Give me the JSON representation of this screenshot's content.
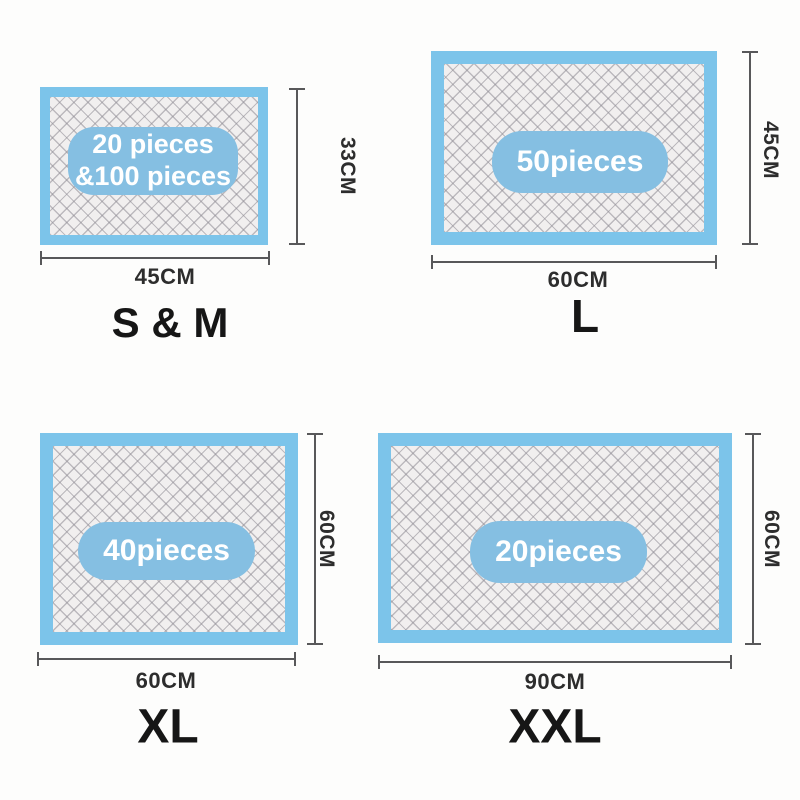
{
  "colors": {
    "background": "#fdfdfc",
    "pad_border_blue": "#7cc4ea",
    "pad_core_bg": "#f1efef",
    "pad_core_line": "#908d95",
    "badge_blue": "#85bfe2",
    "badge_text": "#ffffff",
    "dimension_line": "#58585a",
    "dimension_text": "#2d2d2d",
    "title_text": "#161616"
  },
  "panels": [
    {
      "id": "s-m",
      "title": "S & M",
      "badge_line1": "20 pieces",
      "badge_line2": "&100 pieces",
      "width_label": "45CM",
      "height_label": "33CM"
    },
    {
      "id": "l",
      "title": "L",
      "badge_line1": "50pieces",
      "badge_line2": "",
      "width_label": "60CM",
      "height_label": "45CM"
    },
    {
      "id": "xl",
      "title": "XL",
      "badge_line1": "40pieces",
      "badge_line2": "",
      "width_label": "60CM",
      "height_label": "60CM"
    },
    {
      "id": "xxl",
      "title": "XXL",
      "badge_line1": "20pieces",
      "badge_line2": "",
      "width_label": "90CM",
      "height_label": "60CM"
    }
  ]
}
